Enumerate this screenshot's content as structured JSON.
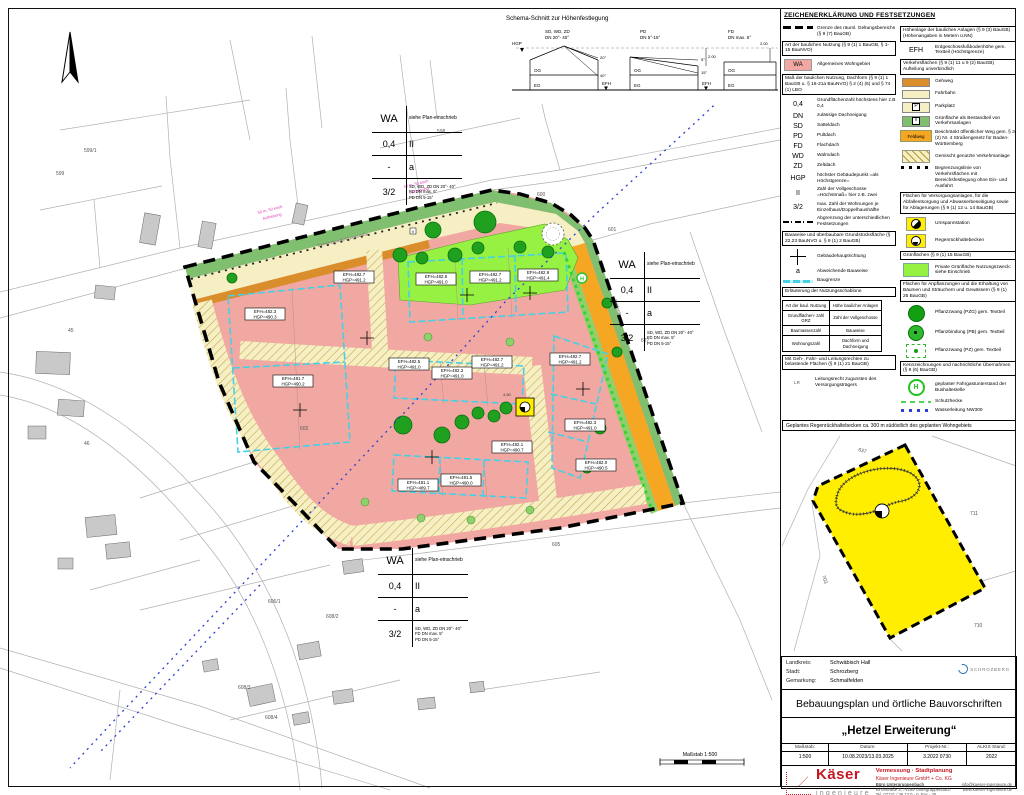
{
  "sheet": {
    "scalebar": "Maßstab 1:500"
  },
  "schema": {
    "title": "Schema-Schnitt zur Höhenfestlegung",
    "h1a": "SD, WD, ZD",
    "h1b": "DN 20°- 40°",
    "h2a": "PD",
    "h2b": "DN 5°-15°",
    "h3a": "FD",
    "h3b": "DN max. 5°",
    "hgp": "HGP",
    "efh": "EFH",
    "og": "OG",
    "eg": "EG",
    "a20": "20°",
    "a40": "40°",
    "a5": "5°",
    "a15": "15°",
    "dim": "2.00"
  },
  "map": {
    "schablone": {
      "wa": "WA",
      "row1r": "siehe Plan-einschrieb",
      "grz": "0,4",
      "floors": "II",
      "dash": "-",
      "bw": "a",
      "wz": "3/2",
      "roof1": "SD, WD, ZD DN 20°- 40°",
      "roof2": "FD DN max. 5°",
      "roof3": "PD DN 5-15°"
    },
    "parcels": [
      "598",
      "599",
      "599/1",
      "600",
      "601",
      "602",
      "605",
      "606/1",
      "608/2",
      "608/3",
      "608/4",
      "627",
      "45",
      "46"
    ],
    "efh": [
      {
        "e": "EFH=482.3",
        "h": "HGP=490.3"
      },
      {
        "e": "EFH=481.7",
        "h": "HGP=490.2"
      },
      {
        "e": "EFH=482.7",
        "h": "HGP=491.2"
      },
      {
        "e": "EFH=482.5",
        "h": "HGP=491.0"
      },
      {
        "e": "EFH=482.7",
        "h": "HGP=491.2"
      },
      {
        "e": "EFH=482.9",
        "h": "HGP=491.4"
      },
      {
        "e": "EFH=482.5",
        "h": "HGP=491.0"
      },
      {
        "e": "EFH=482.3",
        "h": "HGP=491.0"
      },
      {
        "e": "EFH=482.7",
        "h": "HGP=491.2"
      },
      {
        "e": "EFH=482.7",
        "h": "HGP=491.2"
      },
      {
        "e": "EFH=482.3",
        "h": "HGP=491.0"
      },
      {
        "e": "EFH=482.0",
        "h": "HGP=490.5"
      },
      {
        "e": "EFH=482.1",
        "h": "HGP=490.7"
      },
      {
        "e": "EFH=481.1",
        "h": "HGP=489.7"
      },
      {
        "e": "EFH=481.5",
        "h": "HGP=490.0"
      }
    ],
    "labels": {
      "street": "Gemeindeverbindungsstraße",
      "feldweg": "Feldweg",
      "gruen": "Grünfläche",
      "speed": "50 m, 50 km/h",
      "speed2": "Aufhebung",
      "dim": "4.50",
      "v": "V",
      "h_stop": "H"
    }
  },
  "legend": {
    "title": "ZEICHENERKLÄRUNG UND FESTSETZUNGEN",
    "wa_badge": "WA",
    "feldweg_badge": "Feldweg",
    "sym": {
      "grz": "0,4",
      "dn": "DN",
      "sd": "SD",
      "pd": "PD",
      "fd": "FD",
      "wd": "WD",
      "zd": "ZD",
      "hgp": "HGP",
      "ii": "II",
      "wz": "3/2",
      "a": "a",
      "efh": "EFH",
      "lr": "LR",
      "h": "H",
      "p": "P",
      "v": "V"
    },
    "headers": {
      "art": "Art der baulichen Nutzung (§ 9 (1) 1 BauGB, § 1-15 BauNVO)",
      "mass": "Maß der baulichen Nutzung, Dachform (§ 9 (1) 1 BauGB u. § 16-21a BauNVO) § 2 (4) (6) und § 74 (1) LBO",
      "bauweise": "Bauweise und überbaubare Grundstücksfläche (§ 22,23 BauNVO u. § 9 (1) 2 BauGB)",
      "schablone": "Erläuterung der Nutzungsschablone",
      "geh": "Mit Geh-, Fahr- und Leitungsrechten zu belastende Flächen (§ 9 (1) 21 BauGB)",
      "hoehe": "Höhenlage der baulichen Anlagen (§ 9 (3) BauGB) (Höhenangaben in Metern ü.NN)",
      "verkehr": "Verkehrsflächen (§ 9 (1) 11 u 9 (2) BauGB) Aufteilung unverbindlich",
      "versorg": "Flächen für Versorgungsanlagen, für die Abfallentsorgung und Abwasserbeseitigung sowie für Ablagerungen (§ 9 (1) 12 u. 14 BauGB)",
      "gruen": "Grünflächen (§ 9 (1) 15 BauGB)",
      "pflanz": "Flächen für Anpflanzungen und die Erhaltung von Bäumen und Sträuchern und Gewässern (§ 9 (1) 25 BauGB)",
      "kennz": "Kennzeichnungen und nachrichtliche Übernahmen (§ 9 (6) BauGB)"
    },
    "labels": {
      "grenze": "Grenze des räuml. Geltungsbereichs (§ 9 (7) BauGB)",
      "wa": "Allgemeines Wohngebiet",
      "grz": "Grundflächenzahl höchstens hier z.B 0,4",
      "dn": "zulässige Dachneigung",
      "sd": "Satteldach",
      "pd": "Pultdach",
      "fd": "Flachdach",
      "wd": "Walmdach",
      "zd": "Zeltdach",
      "hgp": "höchster Gebäudepunkt =als Höchstgrenze=",
      "ii": "Zahl der Vollgeschosse =Höchstmaß= hier z.B. zwei",
      "wz": "max. Zahl der Wohnungen je Einzelhaus/Doppelhaushälfte",
      "abgrenzung": "Abgrenzung der unterschiedlichen Festsetzungen",
      "hauptrichtung": "Gebäudehauptrichtung",
      "bauweise": "Abweichende Bauweise",
      "baugrenze": "Baugrenze",
      "leitungsrecht": "Leitungsrecht zugunsten des Versorgungsträgers",
      "efh": "Erdgeschossfußbodenhöhe gem. Textteil (Höchstgrenze)",
      "gehweg": "Gehweg",
      "fahrbahn": "Fahrbahn",
      "parkplatz": "Parkplatz",
      "gruen_verkehr": "Grünfläche als Bestandteil von Verkehrsanlagen",
      "feldweg": "Beschränkt öffentlicher Weg gem. § 3 (2) Nr. 4 Straßengesetz für Baden-Württemberg",
      "gemischt": "Gemischt genutzte Verkehrsanlage",
      "begrenzung": "Begrenzungslinie von Verkehrsflächen mit Bereichsfestlegung ohne Ein- und Ausfahrt",
      "umspann": "Umspannstation",
      "regen": "Regenrückhaltebecken",
      "gruen_privat": "Private Grünfläche Nutzungszweck: siehe Einschrieb",
      "pzg": "Pflanzzwang (PZG) gem. Textteil",
      "pb": "Pflanzbindung (PB) gem. Textteil",
      "pz": "Pflanzzwang (PZ) gem. Textteil",
      "bushalt": "geplanter Fahrgastunterstand der Bushaltestelle",
      "hecke": "Schutzhecke",
      "wasser": "Wasserleitung NW300"
    },
    "table": {
      "r1c1": "Art der baul. Nutzung",
      "r1c2": "Höhe baulicher Anlagen",
      "r2c1": "Grundflächen- zahl GRZ",
      "r2c2": "Zahl der Vollgeschosse",
      "r3c1": "Baumassenzahl",
      "r3c2": "Bauweise",
      "r4c1": "Wohnungszahl",
      "r4c2": "Dachform und Dachneigung"
    }
  },
  "inset": {
    "title": "Geplantes Regenrückhaltebecken ca. 300 m südöstlich des geplanten Wohngebiets",
    "parcels": [
      "711",
      "710",
      "637",
      "703"
    ]
  },
  "titleblock": {
    "landkreis_label": "Landkreis:",
    "landkreis": "Schwäbisch Hall",
    "stadt_label": "Stadt:",
    "stadt": "Schrozberg",
    "gemarkung_label": "Gemarkung:",
    "gemarkung": "Schmalfelden",
    "city_logo": "SCHROZBERG",
    "title": "Bebauungsplan und örtliche Bauvorschriften",
    "subtitle": "„Hetzel Erweiterung“",
    "meta": {
      "m_label": "Maßstab:",
      "m": "1:500",
      "d_label": "Datum:",
      "d": "10.08.2023/13.03.2025",
      "p_label": "Projekt-Nr.:",
      "p": "3.2022 0730",
      "a_label": "ALKIS Stand:",
      "a": "2022"
    },
    "logo": {
      "name": "Käser",
      "sub": "ingenieure",
      "line1": "Vermessung · Stadtplanung",
      "line2": "Käser Ingenieure GmbH + Co. KG",
      "office": "Büro Untergruppenbach",
      "addr": "Kirchstraße 3, 74199 Untergruppenbach",
      "tel": "Tel. 07131 / 38 13 0 - 0, Fax - 25",
      "mail": "info@kaeser-ingenieure.de",
      "web": "www.kaeser-ingenieure.de"
    }
  }
}
